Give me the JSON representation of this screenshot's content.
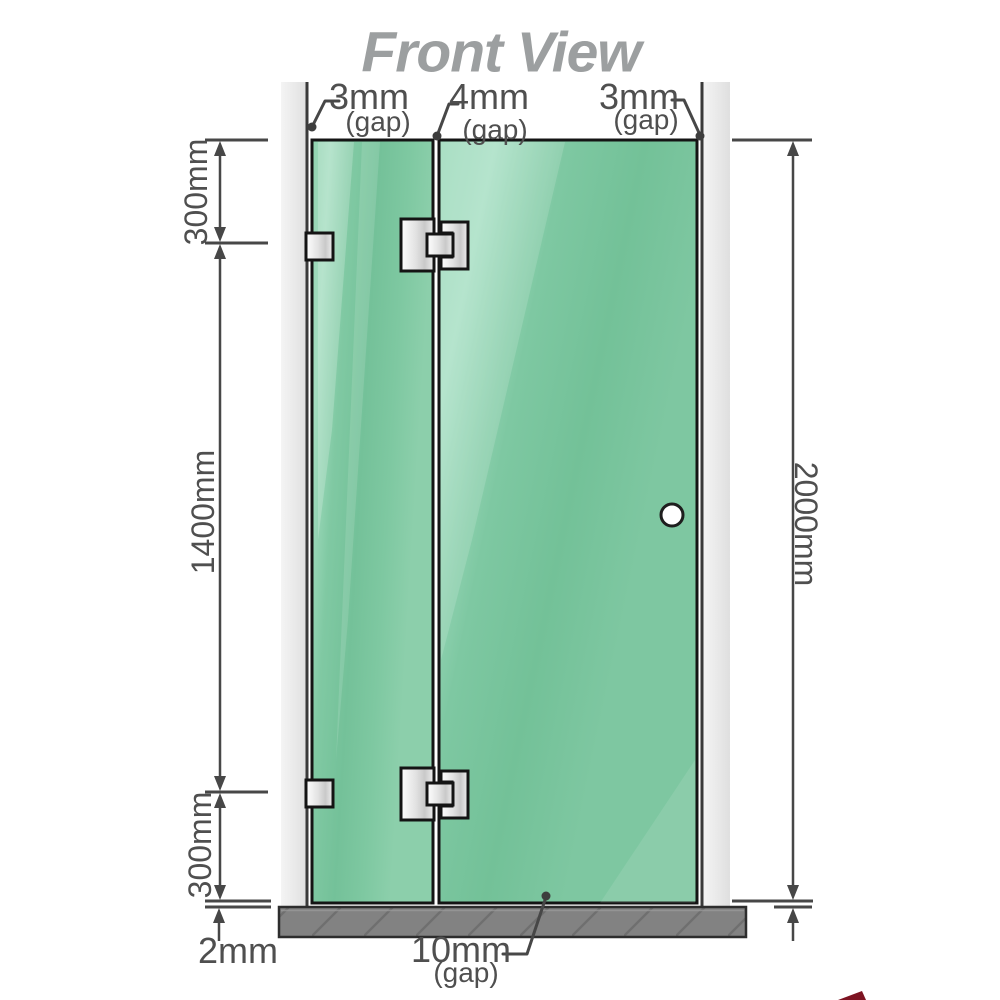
{
  "title": "Front View",
  "gaps": {
    "top_left": {
      "value": "3mm",
      "suffix": "(gap)"
    },
    "top_middle": {
      "value": "4mm",
      "suffix": "(gap)"
    },
    "top_right": {
      "value": "3mm",
      "suffix": "(gap)"
    },
    "bottom_door": {
      "value": "10mm",
      "suffix": "(gap)"
    }
  },
  "dimensions": {
    "left_top": "300mm",
    "left_middle": "1400mm",
    "left_bottom": "300mm",
    "right_full": "2000mm",
    "floor_clearance": "2mm"
  },
  "colors": {
    "glass": "#7ec8a1",
    "glass_highlight": "#a9e0c5",
    "wall": "#e8e8e8",
    "floor": "#828282",
    "line": "#474747",
    "title_text": "#9c9fa0",
    "outline": "#141414",
    "logo_sliver": "#7d1322"
  }
}
